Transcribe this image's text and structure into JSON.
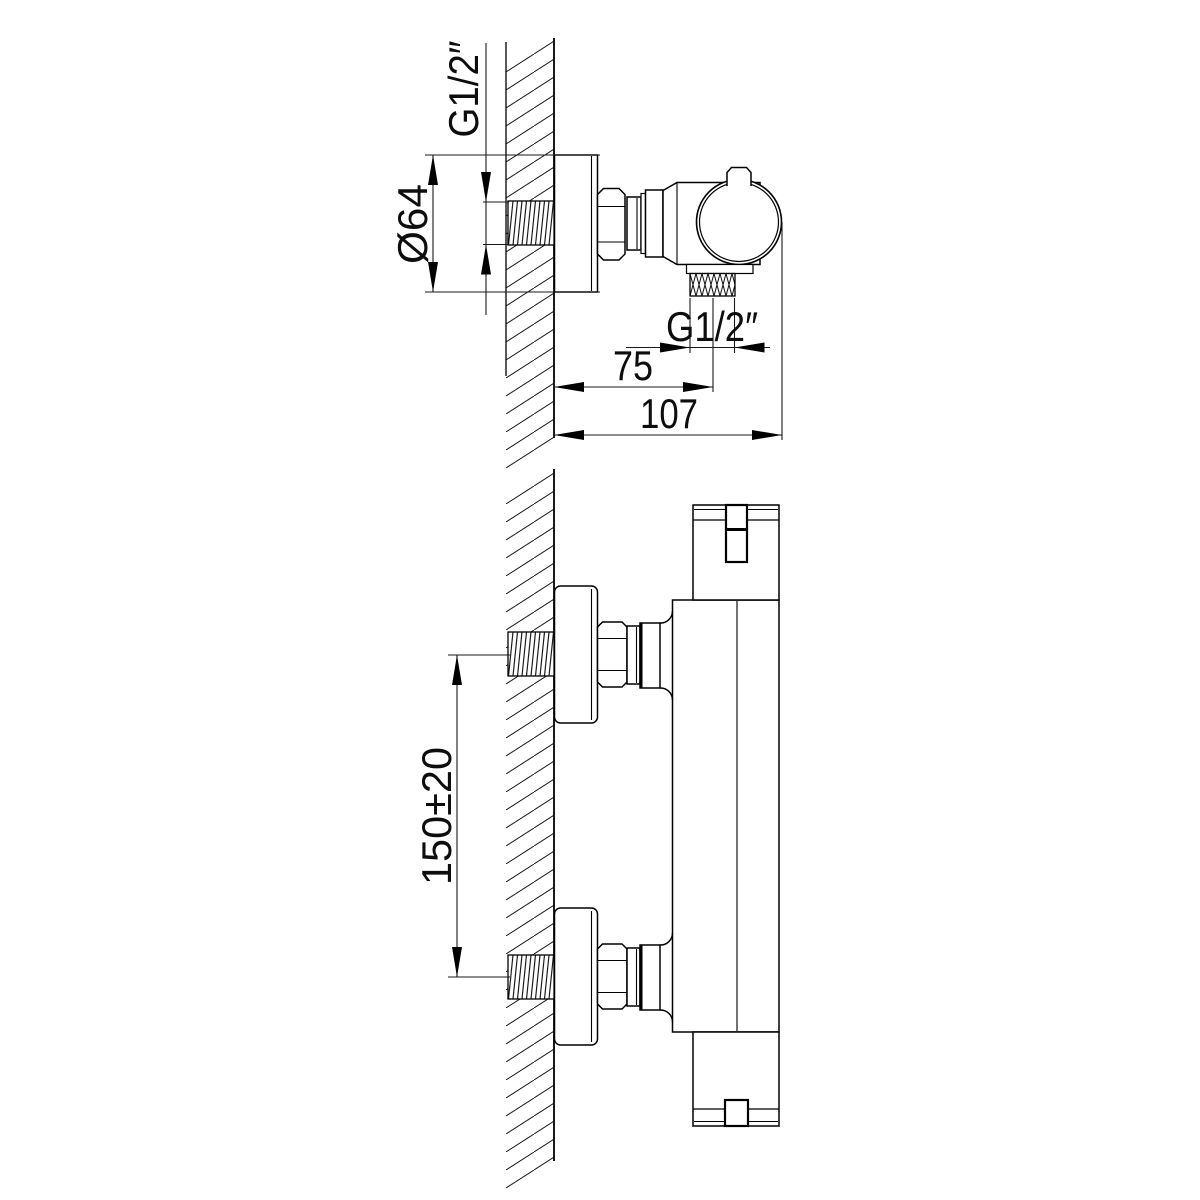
{
  "drawing": {
    "type": "technical-dimension-drawing",
    "subject": "wall-mounted thermostatic shower mixer valve",
    "colors": {
      "ink": "#000000",
      "background": "#ffffff"
    },
    "views": {
      "top_view": {
        "title": "side section view (valve on wall, from above)",
        "labels": {
          "inlet_thread": "G1/2″",
          "flange_diameter": "Ø64",
          "outlet_thread": "G1/2″",
          "outlet_offset": "75",
          "overall_depth": "107"
        }
      },
      "front_view": {
        "title": "installation view (two wall unions)",
        "labels": {
          "inlet_spacing": "150±20"
        }
      }
    }
  }
}
